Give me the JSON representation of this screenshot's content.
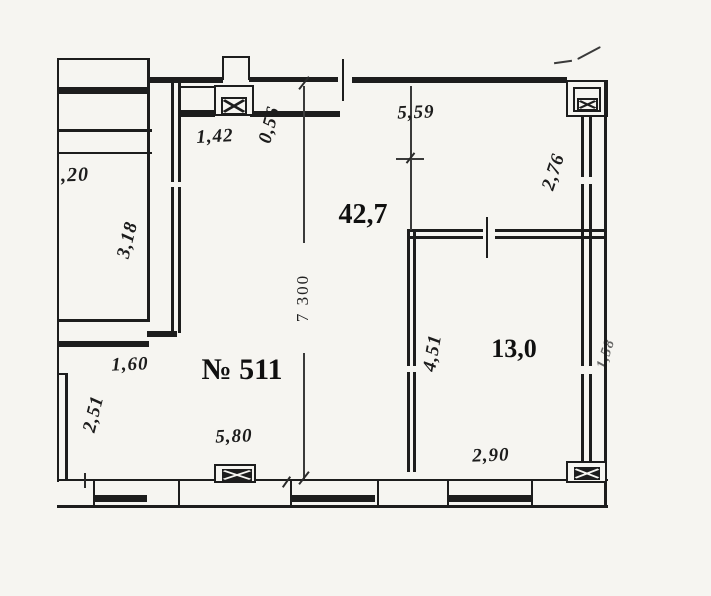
{
  "plan": {
    "unit_number": "№ 511",
    "rooms": {
      "living": {
        "area": "42,7"
      },
      "bedroom": {
        "area": "13,0"
      }
    },
    "dimensions": {
      "top_niche_width": "1,42",
      "niche_depth": "0,56",
      "living_width_top": "5,59",
      "right_wall_upper": "2,76",
      "neighbor_partial": ",20",
      "neighbor_room_depth": "3,18",
      "living_height": "7 300",
      "alcove_width": "1,60",
      "alcove_depth": "2,51",
      "living_width_bottom": "5,80",
      "bedroom_height": "4,51",
      "bedroom_width": "2,90",
      "right_edge_partial": "1,58"
    },
    "colors": {
      "ink": "#1d1d1d",
      "paper": "#f6f5f1"
    }
  }
}
